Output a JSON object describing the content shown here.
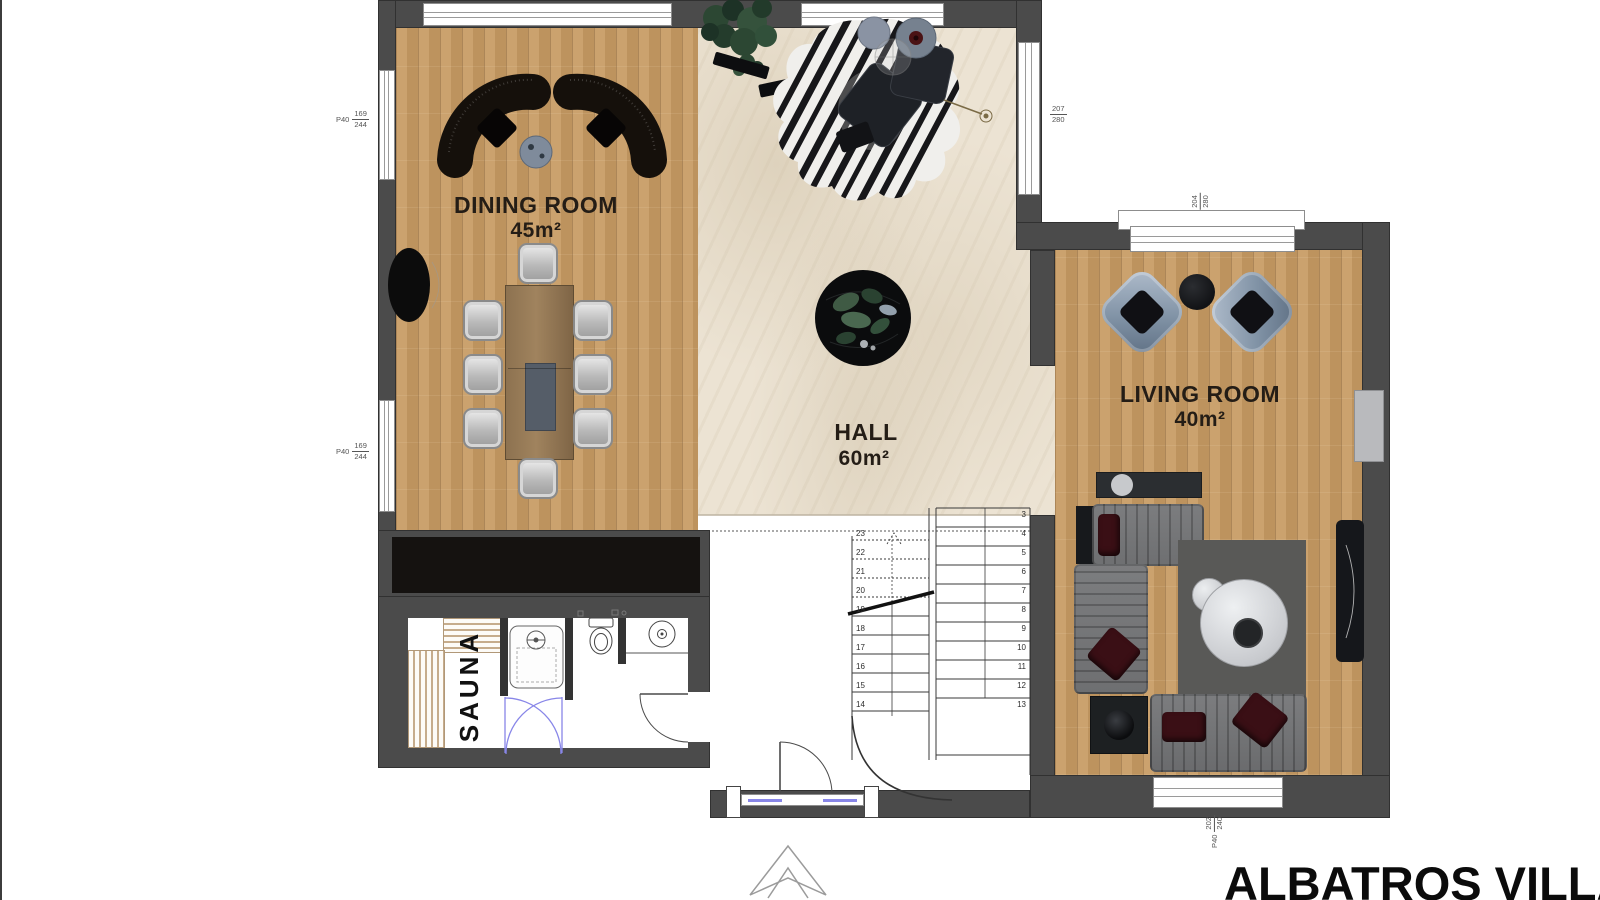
{
  "title": "ALBATROS VILLA",
  "rooms": {
    "dining": {
      "label": "DINING ROOM",
      "area": "45m²"
    },
    "hall": {
      "label": "HALL",
      "area": "60m²"
    },
    "living": {
      "label": "LIVING ROOM",
      "area": "40m²"
    },
    "sauna": {
      "label": "SAUNA"
    }
  },
  "stairs": {
    "right_numbers": [
      "3",
      "4",
      "5",
      "6",
      "7",
      "8",
      "9",
      "10",
      "11",
      "12",
      "13"
    ],
    "left_numbers": [
      "23",
      "22",
      "21",
      "20",
      "19",
      "18",
      "17",
      "16",
      "15",
      "14"
    ]
  },
  "dimensions": {
    "left_window_top": {
      "prefix": "P40",
      "num": "169",
      "den": "244"
    },
    "left_window_bottom": {
      "prefix": "P40",
      "num": "169",
      "den": "244"
    },
    "hall_right_window": {
      "num": "207",
      "den": "280"
    },
    "living_top_window": {
      "num": "204",
      "den": "280"
    },
    "living_bottom_window": {
      "num": "202",
      "den": "240",
      "prefix": "P40"
    }
  },
  "colors": {
    "wall": "#4b4b4b",
    "wood": "#c79b63",
    "marble": "#ece3d3",
    "glazing": "#8886e8"
  }
}
